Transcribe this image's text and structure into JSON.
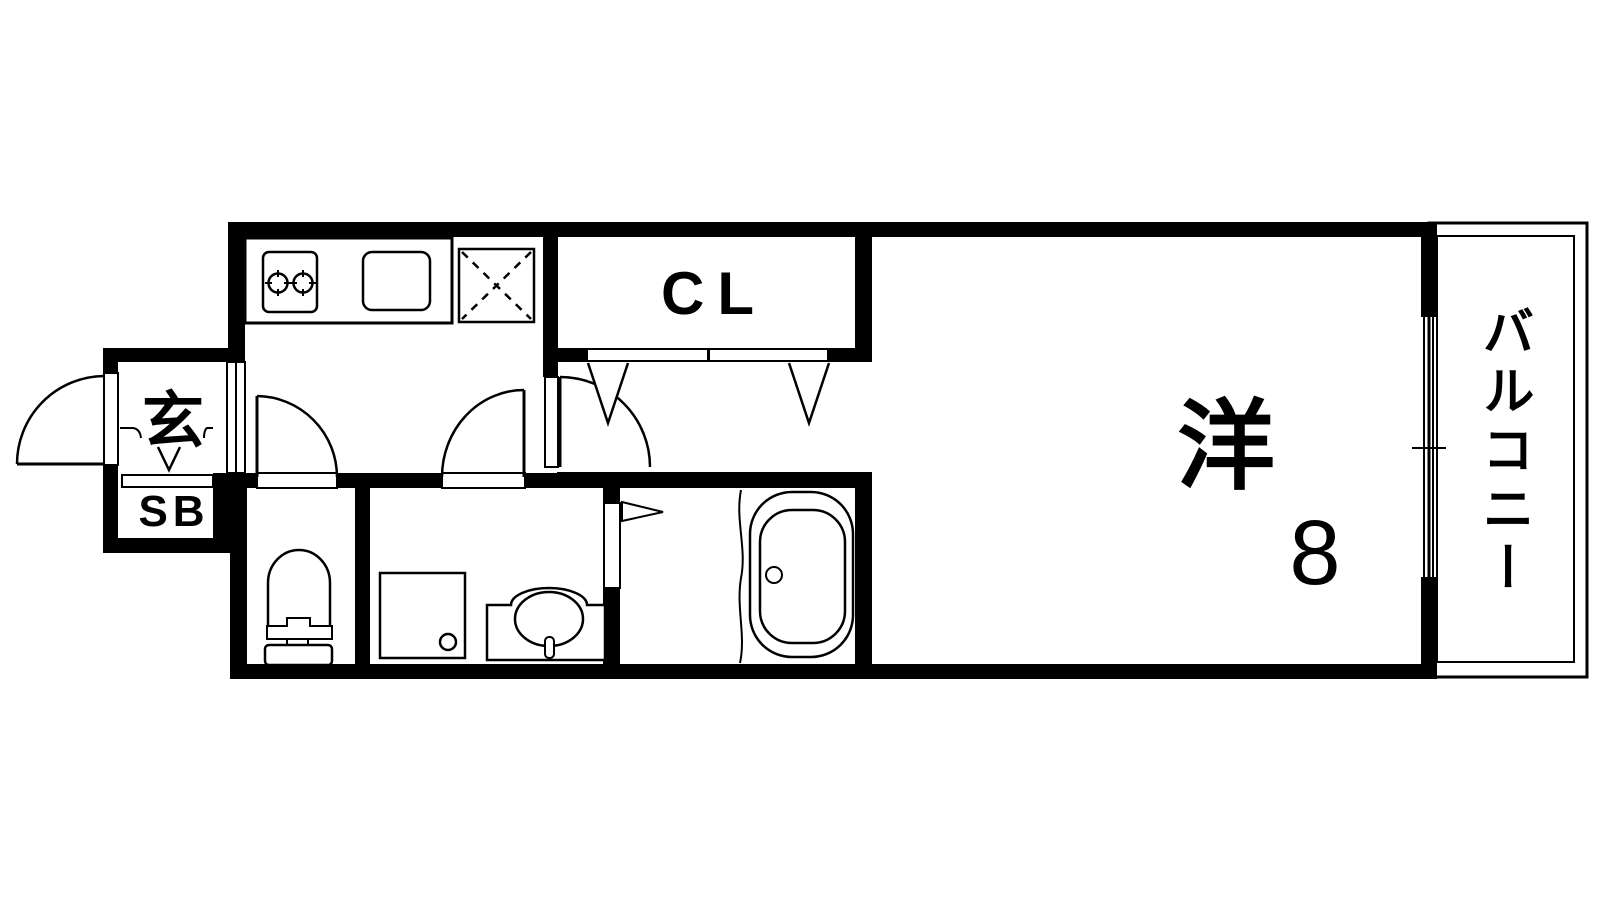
{
  "plan": {
    "background": "#ffffff",
    "line_color": "#000000"
  },
  "rooms": {
    "entrance": {
      "label": "玄"
    },
    "shoe_box": {
      "label": "SB"
    },
    "closet": {
      "label": "CL"
    },
    "western_room": {
      "label": "洋",
      "size": "8"
    },
    "balcony": {
      "label": "バルコニー"
    }
  },
  "fixtures": {
    "kitchen": [
      "stove-icon",
      "sink-icon",
      "refrigerator-icon"
    ],
    "sanitary": [
      "toilet-icon",
      "shower-tray-icon",
      "washbasin-icon",
      "bathtub-icon"
    ]
  },
  "symbols": [
    "door-swing",
    "closet-folding-door",
    "bath-folding-door",
    "sliding-window",
    "entrance-step"
  ]
}
